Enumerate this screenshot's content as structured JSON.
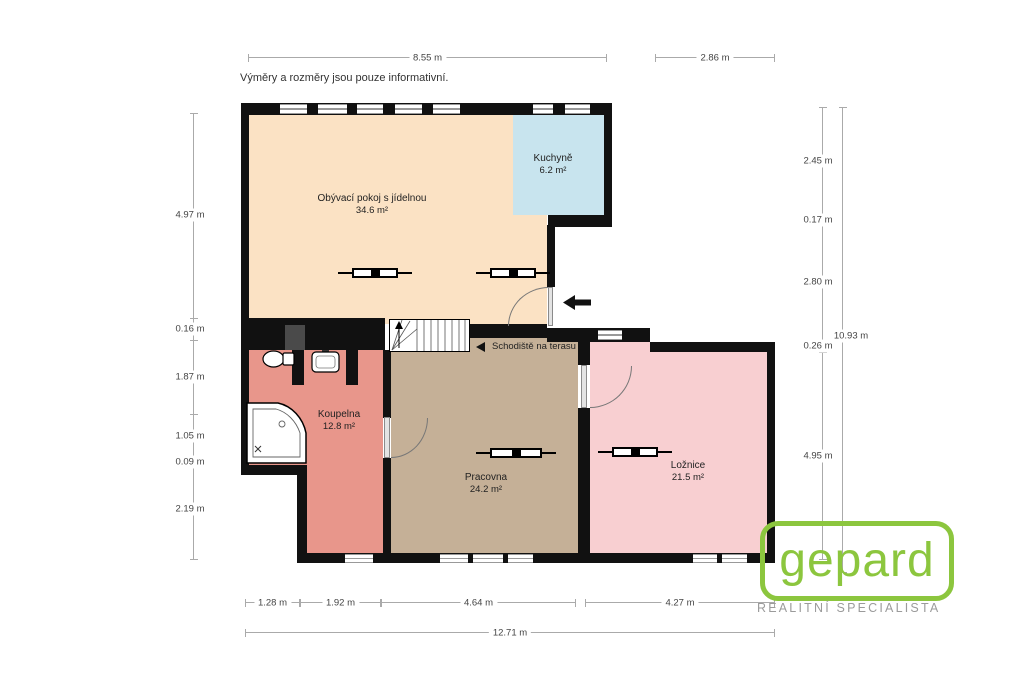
{
  "disclaimer": "Výměry a rozměry jsou pouze informativní.",
  "rooms": [
    {
      "name": "Obývací pokoj s jídelnou",
      "area": "34.6 m²",
      "color": "#fbe2c4"
    },
    {
      "name": "Kuchyně",
      "area": "6.2 m²",
      "color": "#c8e4ee"
    },
    {
      "name": "Koupelna",
      "area": "12.8 m²",
      "color": "#e8968b"
    },
    {
      "name": "Pracovna",
      "area": "24.2 m²",
      "color": "#c5b097"
    },
    {
      "name": "Ložnice",
      "area": "21.5 m²",
      "color": "#f8cfd1"
    }
  ],
  "annotations": {
    "stairs_label": "Schodiště na terasu"
  },
  "dims": {
    "top": [
      "8.55 m",
      "2.86 m"
    ],
    "left": [
      "4.97 m",
      "0.16 m",
      "1.87 m",
      "1.05 m",
      "0.09 m",
      "2.19 m"
    ],
    "right": [
      "2.45 m",
      "0.17 m",
      "2.80 m",
      "0.26 m",
      "4.95 m"
    ],
    "right_total": "10.93 m",
    "bottom": [
      "1.28 m",
      "1.92 m",
      "4.64 m",
      "4.27 m"
    ],
    "bottom_total": "12.71 m"
  },
  "logo": {
    "brand": "gepard",
    "tagline": "REALITNÍ SPECIALISTA",
    "green": "#8cc63e",
    "gray": "#9b9b9b"
  },
  "colors": {
    "wall": "#111111"
  }
}
